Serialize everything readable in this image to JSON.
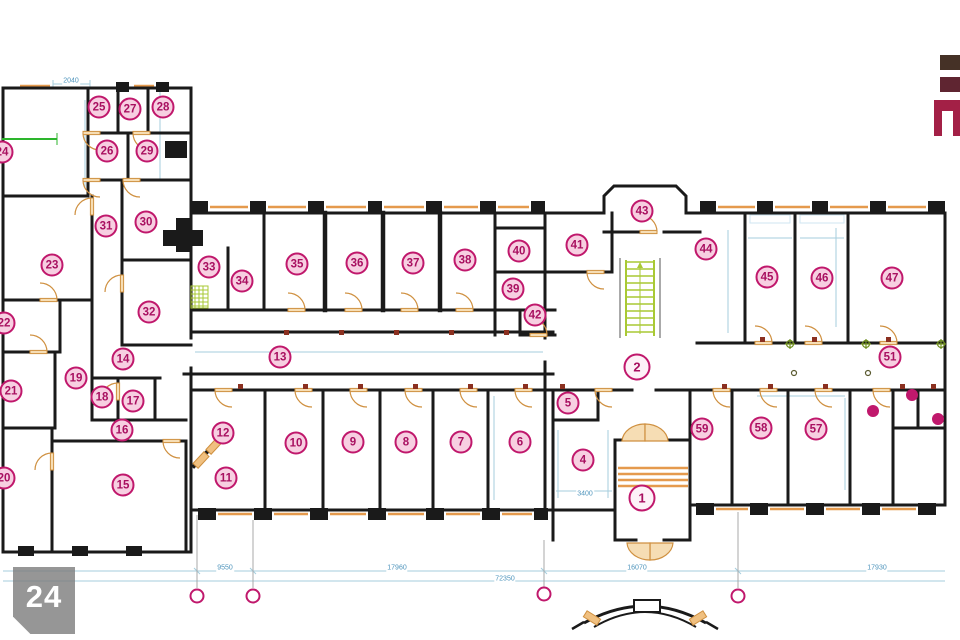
{
  "page": {
    "background": "#ffffff",
    "type": "architectural floor plan"
  },
  "colors": {
    "wall": "#1a1a1a",
    "marker_ring": "#c0186c",
    "marker_fill": "#f7cfe1",
    "marker_text": "#a81060",
    "door": "#cf9040",
    "door_fill": "#f6ddb4",
    "window": "#e59a4d",
    "dim_line": "#a6cede",
    "dim_text": "#4e94bc",
    "stairs_green": "#a9c934",
    "accent_green": "#2db52d",
    "marker_red_square": "#8b3020",
    "badge_bg": "rgba(124,124,124,.8)",
    "badge_text": "#ffffff",
    "logo_bar1": "#453126",
    "logo_bar2": "#5f2531",
    "logo_mark": "#a32046"
  },
  "badge": {
    "number": "24"
  },
  "rooms": [
    {
      "n": "1",
      "x": 642,
      "y": 498,
      "big": true
    },
    {
      "n": "2",
      "x": 637,
      "y": 367,
      "big": true
    },
    {
      "n": "4",
      "x": 583,
      "y": 460
    },
    {
      "n": "5",
      "x": 568,
      "y": 403
    },
    {
      "n": "6",
      "x": 520,
      "y": 442
    },
    {
      "n": "7",
      "x": 461,
      "y": 442
    },
    {
      "n": "8",
      "x": 406,
      "y": 442
    },
    {
      "n": "9",
      "x": 353,
      "y": 442
    },
    {
      "n": "10",
      "x": 296,
      "y": 443
    },
    {
      "n": "11",
      "x": 226,
      "y": 478
    },
    {
      "n": "12",
      "x": 223,
      "y": 433
    },
    {
      "n": "13",
      "x": 280,
      "y": 357
    },
    {
      "n": "14",
      "x": 123,
      "y": 359
    },
    {
      "n": "15",
      "x": 123,
      "y": 485
    },
    {
      "n": "16",
      "x": 122,
      "y": 430
    },
    {
      "n": "17",
      "x": 133,
      "y": 401
    },
    {
      "n": "18",
      "x": 102,
      "y": 397
    },
    {
      "n": "19",
      "x": 76,
      "y": 378
    },
    {
      "n": "20",
      "x": 4,
      "y": 478
    },
    {
      "n": "21",
      "x": 11,
      "y": 391
    },
    {
      "n": "22",
      "x": 4,
      "y": 323
    },
    {
      "n": "23",
      "x": 52,
      "y": 265
    },
    {
      "n": "24",
      "x": 2,
      "y": 152
    },
    {
      "n": "25",
      "x": 99,
      "y": 107
    },
    {
      "n": "26",
      "x": 107,
      "y": 151
    },
    {
      "n": "27",
      "x": 130,
      "y": 109
    },
    {
      "n": "28",
      "x": 163,
      "y": 107
    },
    {
      "n": "29",
      "x": 147,
      "y": 151
    },
    {
      "n": "30",
      "x": 146,
      "y": 222
    },
    {
      "n": "31",
      "x": 106,
      "y": 226
    },
    {
      "n": "32",
      "x": 149,
      "y": 312
    },
    {
      "n": "33",
      "x": 209,
      "y": 267
    },
    {
      "n": "34",
      "x": 242,
      "y": 281
    },
    {
      "n": "35",
      "x": 297,
      "y": 264
    },
    {
      "n": "36",
      "x": 357,
      "y": 263
    },
    {
      "n": "37",
      "x": 413,
      "y": 263
    },
    {
      "n": "38",
      "x": 465,
      "y": 260
    },
    {
      "n": "39",
      "x": 513,
      "y": 289
    },
    {
      "n": "40",
      "x": 519,
      "y": 251
    },
    {
      "n": "41",
      "x": 577,
      "y": 245
    },
    {
      "n": "42",
      "x": 535,
      "y": 315
    },
    {
      "n": "43",
      "x": 642,
      "y": 211
    },
    {
      "n": "44",
      "x": 706,
      "y": 249
    },
    {
      "n": "45",
      "x": 767,
      "y": 277
    },
    {
      "n": "46",
      "x": 822,
      "y": 278
    },
    {
      "n": "47",
      "x": 892,
      "y": 278
    },
    {
      "n": "51",
      "x": 890,
      "y": 357
    },
    {
      "n": "57",
      "x": 816,
      "y": 429
    },
    {
      "n": "58",
      "x": 761,
      "y": 428
    },
    {
      "n": "59",
      "x": 702,
      "y": 429
    }
  ],
  "dots": [
    {
      "x": 873,
      "y": 411
    },
    {
      "x": 912,
      "y": 395
    },
    {
      "x": 938,
      "y": 419
    }
  ],
  "axis_bubbles": [
    {
      "x": 197,
      "y": 596
    },
    {
      "x": 253,
      "y": 596
    },
    {
      "x": 544,
      "y": 594
    },
    {
      "x": 738,
      "y": 596
    }
  ],
  "dimension_labels": [
    {
      "text": "2040",
      "x": 71,
      "y": 81
    },
    {
      "text": "9550",
      "x": 225,
      "y": 568
    },
    {
      "text": "17960",
      "x": 397,
      "y": 568
    },
    {
      "text": "16070",
      "x": 637,
      "y": 568
    },
    {
      "text": "17930",
      "x": 877,
      "y": 568
    },
    {
      "text": "72350",
      "x": 505,
      "y": 579
    },
    {
      "text": "3400",
      "x": 585,
      "y": 494
    }
  ]
}
